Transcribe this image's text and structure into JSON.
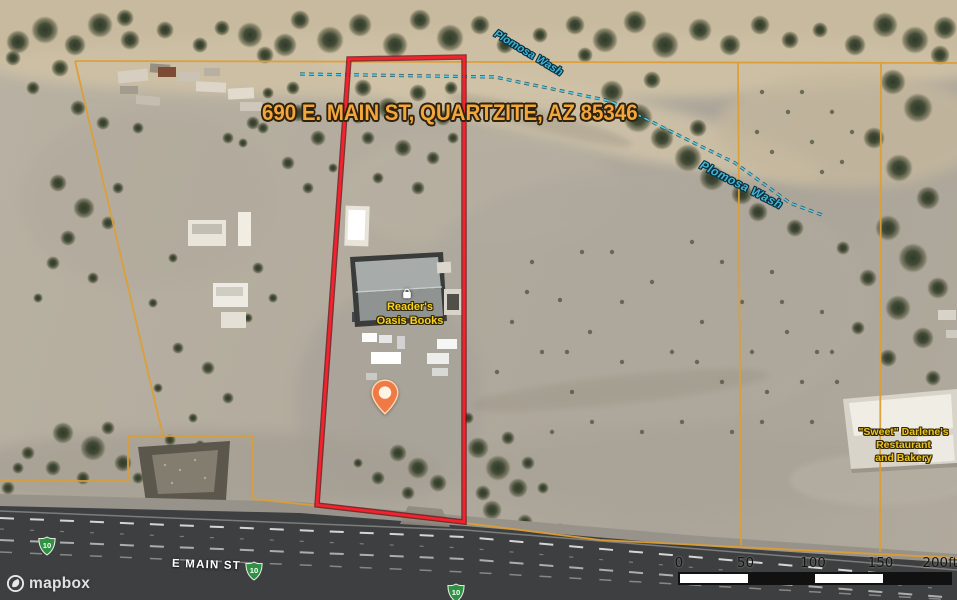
{
  "map": {
    "address_label": "690 E. MAIN ST, QUARTZITE, AZ 85346",
    "attribution_logo": "mapbox"
  },
  "labels": {
    "wash_top": "Plomosa Wash",
    "wash_right": "Plomosa Wash",
    "poi_store_line1": "Reader's",
    "poi_store_line2": "Oasis Books",
    "restaurant_line1": "\"Sweet\" Darlene's",
    "restaurant_line2": "Restaurant",
    "restaurant_line3": "and Bakery",
    "road_name": "E MAIN ST",
    "route_number": "10"
  },
  "scale_bar": {
    "ticks": [
      "0",
      "50",
      "100",
      "150",
      "200ft"
    ]
  },
  "marker": {
    "type": "location-pin"
  },
  "colors": {
    "property_boundary": "#f5222d",
    "parcel_lines": "#dd9e35",
    "wash_line": "#55cbe4",
    "address_text": "#f2a63b",
    "poi_text": "#f8d31d",
    "restaurant_text": "#ecc31e",
    "shield_green": "#2f9242",
    "marker_orange": "#f07a45"
  }
}
